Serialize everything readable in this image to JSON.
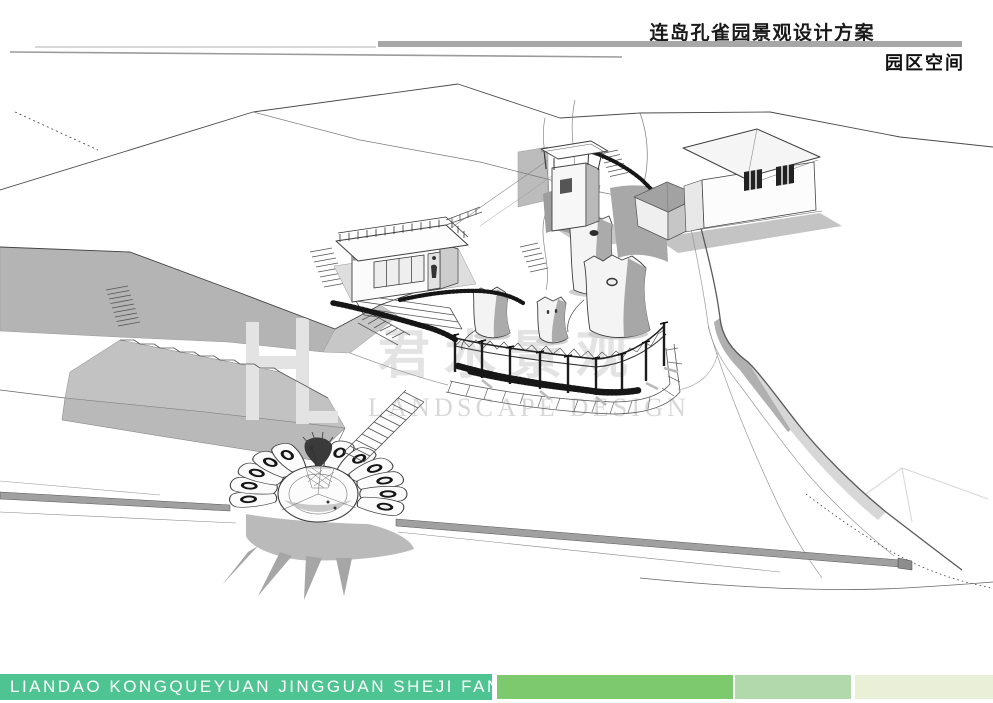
{
  "header": {
    "title": "连岛孔雀园景观设计方案",
    "section_label": "园区空间"
  },
  "watermark": {
    "cn": "君水景观",
    "en": "LANDSCAPE DESIGN"
  },
  "drawing": {
    "type": "aerial-sketch",
    "elements": [
      "watchtower",
      "cottage",
      "gatehouse",
      "lookout-pavilion",
      "rock-stumps",
      "pergola-fence",
      "hedge-rows",
      "peacock-plaza",
      "peacock-statue",
      "terraced-cliffs",
      "stairs",
      "boundary-wall",
      "river-edge"
    ]
  },
  "footer": {
    "slogan": "LIANDAO KONGQUEYUAN JINGGUAN SHEJI FANGAN"
  },
  "theme": {
    "teal": "#4ec492",
    "green": "#7cc96e",
    "green-light": "#b2d9ac",
    "green-pale": "#eaf0d8",
    "rule-gray": "#a7a7a7",
    "ink": "#1a1a1a",
    "watermark-gray": "#d8d8d8"
  }
}
